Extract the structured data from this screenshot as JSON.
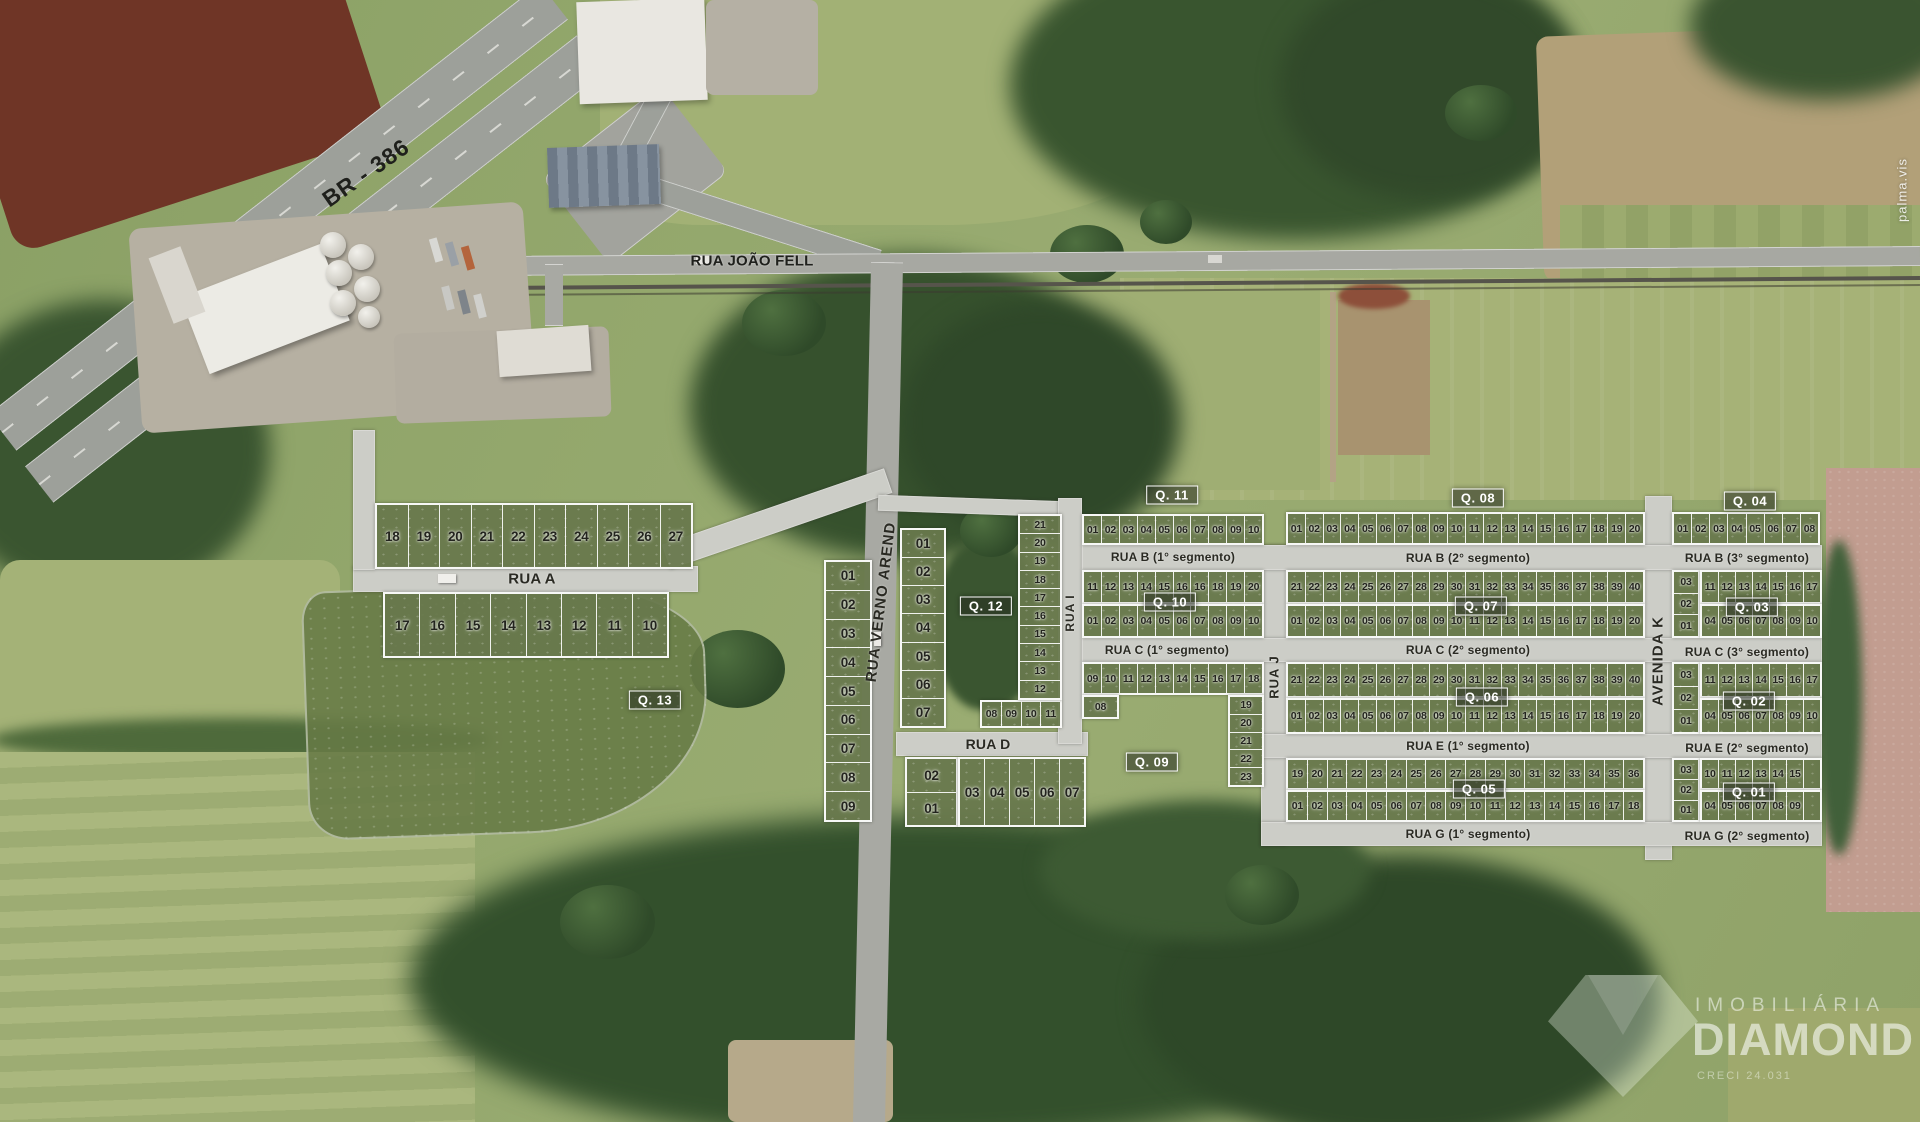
{
  "map": {
    "road_labels": {
      "br386": "BR - 386",
      "rua_joao_fell": "RUA JOÃO FELL",
      "rua_a": "RUA A",
      "rua_d": "RUA D",
      "rua_verno_arend": "RUA VERNO AREND",
      "rua_i": "RUA I",
      "rua_j": "RUA J",
      "avenida_k": "AVENIDA K",
      "rua_b_seg1": "RUA B (1° segmento)",
      "rua_b_seg2": "RUA B (2° segmento)",
      "rua_b_seg3": "RUA B (3° segmento)",
      "rua_c_seg1": "RUA C (1° segmento)",
      "rua_c_seg2": "RUA C (2° segmento)",
      "rua_c_seg3": "RUA C (3° segmento)",
      "rua_e_seg1": "RUA E (1° segmento)",
      "rua_e_seg2": "RUA E (2° segmento)",
      "rua_g_seg1": "RUA G (1° segmento)",
      "rua_g_seg2": "RUA G (2° segmento)"
    },
    "badges": [
      {
        "id": "q01",
        "label": "Q. 01",
        "x": 1749,
        "y": 792
      },
      {
        "id": "q02",
        "label": "Q. 02",
        "x": 1749,
        "y": 701
      },
      {
        "id": "q03",
        "label": "Q. 03",
        "x": 1752,
        "y": 607
      },
      {
        "id": "q04",
        "label": "Q. 04",
        "x": 1750,
        "y": 501
      },
      {
        "id": "q05",
        "label": "Q. 05",
        "x": 1479,
        "y": 789
      },
      {
        "id": "q06",
        "label": "Q. 06",
        "x": 1482,
        "y": 697
      },
      {
        "id": "q07",
        "label": "Q. 07",
        "x": 1481,
        "y": 606
      },
      {
        "id": "q08",
        "label": "Q. 08",
        "x": 1478,
        "y": 498
      },
      {
        "id": "q09",
        "label": "Q. 09",
        "x": 1152,
        "y": 762
      },
      {
        "id": "q10",
        "label": "Q. 10",
        "x": 1170,
        "y": 602
      },
      {
        "id": "q11",
        "label": "Q. 11",
        "x": 1172,
        "y": 495
      },
      {
        "id": "q12",
        "label": "Q. 12",
        "x": 986,
        "y": 606
      },
      {
        "id": "q13",
        "label": "Q. 13",
        "x": 655,
        "y": 700
      }
    ],
    "blocks": [
      {
        "name": "q13-north",
        "parts": [
          {
            "type": "row",
            "size": "lg",
            "x": 375,
            "y": 503,
            "w": 318,
            "h": 66,
            "cells": [
              "18",
              "19",
              "20",
              "21",
              "22",
              "23",
              "24",
              "25",
              "26",
              "27"
            ]
          },
          {
            "type": "row",
            "size": "lg",
            "x": 383,
            "y": 592,
            "w": 286,
            "h": 66,
            "cells": [
              "17",
              "16",
              "15",
              "14",
              "13",
              "12",
              "11",
              "10"
            ]
          }
        ]
      },
      {
        "name": "q13-west-col",
        "parts": [
          {
            "type": "col",
            "size": "lg",
            "x": 824,
            "y": 560,
            "w": 48,
            "h": 262,
            "cells": [
              "01",
              "02",
              "03",
              "04",
              "05",
              "06",
              "07",
              "08",
              "09"
            ]
          }
        ]
      },
      {
        "name": "q12",
        "parts": [
          {
            "type": "col",
            "size": "lg",
            "x": 900,
            "y": 528,
            "w": 46,
            "h": 200,
            "cells": [
              "01",
              "02",
              "03",
              "04",
              "05",
              "06",
              "07"
            ]
          },
          {
            "type": "row",
            "size": "",
            "x": 980,
            "y": 700,
            "w": 82,
            "h": 28,
            "cells": [
              "08",
              "09",
              "10",
              "11"
            ]
          },
          {
            "type": "col",
            "size": "",
            "x": 1018,
            "y": 514,
            "w": 44,
            "h": 186,
            "cells": [
              "21",
              "20",
              "19",
              "18",
              "17",
              "16",
              "15",
              "14",
              "13",
              "12"
            ]
          }
        ]
      },
      {
        "name": "q11",
        "parts": [
          {
            "type": "row",
            "size": "",
            "x": 1082,
            "y": 514,
            "w": 182,
            "h": 31,
            "cells": [
              "01",
              "02",
              "03",
              "04",
              "05",
              "06",
              "07",
              "08",
              "09",
              "10"
            ]
          }
        ]
      },
      {
        "name": "q10",
        "parts": [
          {
            "type": "row",
            "size": "",
            "x": 1082,
            "y": 570,
            "w": 182,
            "h": 34,
            "cells": [
              "11",
              "12",
              "13",
              "14",
              "15",
              "16",
              "16",
              "18",
              "19",
              "20"
            ]
          },
          {
            "type": "row",
            "size": "",
            "x": 1082,
            "y": 604,
            "w": 182,
            "h": 34,
            "cells": [
              "01",
              "02",
              "03",
              "04",
              "05",
              "06",
              "07",
              "08",
              "09",
              "10"
            ]
          }
        ]
      },
      {
        "name": "q09-west",
        "parts": [
          {
            "type": "col",
            "size": "lg",
            "x": 905,
            "y": 757,
            "w": 53,
            "h": 70,
            "cells": [
              "02",
              "01"
            ]
          },
          {
            "type": "row",
            "size": "lg",
            "x": 958,
            "y": 757,
            "w": 128,
            "h": 70,
            "cells": [
              "03",
              "04",
              "05",
              "06",
              "07"
            ]
          }
        ]
      },
      {
        "name": "q09",
        "parts": [
          {
            "type": "row",
            "size": "",
            "x": 1082,
            "y": 662,
            "w": 182,
            "h": 33,
            "cells": [
              "09",
              "10",
              "11",
              "12",
              "13",
              "14",
              "15",
              "16",
              "17",
              "18"
            ]
          },
          {
            "type": "row",
            "size": "",
            "x": 1082,
            "y": 695,
            "w": 37,
            "h": 24,
            "cells": [
              "08"
            ]
          },
          {
            "type": "col",
            "size": "",
            "x": 1228,
            "y": 695,
            "w": 36,
            "h": 92,
            "cells": [
              "19",
              "20",
              "21",
              "22",
              "23"
            ]
          }
        ]
      },
      {
        "name": "q08",
        "parts": [
          {
            "type": "row",
            "size": "",
            "x": 1286,
            "y": 512,
            "w": 359,
            "h": 33,
            "cells": [
              "01",
              "02",
              "03",
              "04",
              "05",
              "06",
              "07",
              "08",
              "09",
              "10",
              "11",
              "12",
              "13",
              "14",
              "15",
              "16",
              "17",
              "18",
              "19",
              "20"
            ]
          }
        ]
      },
      {
        "name": "q07",
        "parts": [
          {
            "type": "row",
            "size": "",
            "x": 1286,
            "y": 570,
            "w": 359,
            "h": 34,
            "cells": [
              "21",
              "22",
              "23",
              "24",
              "25",
              "26",
              "27",
              "28",
              "29",
              "30",
              "31",
              "32",
              "33",
              "34",
              "35",
              "36",
              "37",
              "38",
              "39",
              "40"
            ]
          },
          {
            "type": "row",
            "size": "",
            "x": 1286,
            "y": 604,
            "w": 359,
            "h": 34,
            "cells": [
              "01",
              "02",
              "03",
              "04",
              "05",
              "06",
              "07",
              "08",
              "09",
              "10",
              "11",
              "12",
              "13",
              "14",
              "15",
              "16",
              "17",
              "18",
              "19",
              "20"
            ]
          }
        ]
      },
      {
        "name": "q06",
        "parts": [
          {
            "type": "row",
            "size": "",
            "x": 1286,
            "y": 662,
            "w": 359,
            "h": 36,
            "cells": [
              "21",
              "22",
              "23",
              "24",
              "25",
              "26",
              "27",
              "28",
              "29",
              "30",
              "31",
              "32",
              "33",
              "34",
              "35",
              "36",
              "37",
              "38",
              "39",
              "40"
            ]
          },
          {
            "type": "row",
            "size": "",
            "x": 1286,
            "y": 698,
            "w": 359,
            "h": 36,
            "cells": [
              "01",
              "02",
              "03",
              "04",
              "05",
              "06",
              "07",
              "08",
              "09",
              "10",
              "11",
              "12",
              "13",
              "14",
              "15",
              "16",
              "17",
              "18",
              "19",
              "20"
            ]
          }
        ]
      },
      {
        "name": "q05",
        "parts": [
          {
            "type": "row",
            "size": "",
            "x": 1286,
            "y": 758,
            "w": 359,
            "h": 32,
            "cells": [
              "19",
              "20",
              "21",
              "22",
              "23",
              "24",
              "25",
              "26",
              "27",
              "28",
              "29",
              "30",
              "31",
              "32",
              "33",
              "34",
              "35",
              "36"
            ]
          },
          {
            "type": "row",
            "size": "",
            "x": 1286,
            "y": 790,
            "w": 359,
            "h": 32,
            "cells": [
              "01",
              "02",
              "03",
              "04",
              "05",
              "06",
              "07",
              "08",
              "09",
              "10",
              "11",
              "12",
              "13",
              "14",
              "15",
              "16",
              "17",
              "18"
            ]
          }
        ]
      },
      {
        "name": "q04",
        "parts": [
          {
            "type": "row",
            "size": "",
            "x": 1672,
            "y": 512,
            "w": 148,
            "h": 33,
            "cells": [
              "01",
              "02",
              "03",
              "04",
              "05",
              "06",
              "07",
              "08"
            ]
          }
        ]
      },
      {
        "name": "q03",
        "parts": [
          {
            "type": "col",
            "size": "",
            "x": 1672,
            "y": 570,
            "w": 28,
            "h": 68,
            "cells": [
              "03",
              "02",
              "01"
            ]
          },
          {
            "type": "row",
            "size": "",
            "x": 1700,
            "y": 570,
            "w": 122,
            "h": 34,
            "cells": [
              "11",
              "12",
              "13",
              "14",
              "15",
              "16",
              "17"
            ]
          },
          {
            "type": "row",
            "size": "",
            "x": 1700,
            "y": 604,
            "w": 122,
            "h": 34,
            "cells": [
              "04",
              "05",
              "06",
              "07",
              "08",
              "09",
              "10"
            ]
          }
        ]
      },
      {
        "name": "q02",
        "parts": [
          {
            "type": "col",
            "size": "",
            "x": 1672,
            "y": 662,
            "w": 28,
            "h": 72,
            "cells": [
              "03",
              "02",
              "01"
            ]
          },
          {
            "type": "row",
            "size": "",
            "x": 1700,
            "y": 662,
            "w": 122,
            "h": 36,
            "cells": [
              "11",
              "12",
              "13",
              "14",
              "15",
              "16",
              "17"
            ]
          },
          {
            "type": "row",
            "size": "",
            "x": 1700,
            "y": 698,
            "w": 122,
            "h": 36,
            "cells": [
              "04",
              "05",
              "06",
              "07",
              "08",
              "09",
              "10"
            ]
          }
        ]
      },
      {
        "name": "q01",
        "parts": [
          {
            "type": "col",
            "size": "",
            "x": 1672,
            "y": 758,
            "w": 28,
            "h": 64,
            "cells": [
              "03",
              "02",
              "01"
            ]
          },
          {
            "type": "row",
            "size": "",
            "x": 1700,
            "y": 758,
            "w": 122,
            "h": 32,
            "cells": [
              "10",
              "11",
              "12",
              "13",
              "14",
              "15",
              ""
            ]
          },
          {
            "type": "row",
            "size": "",
            "x": 1700,
            "y": 790,
            "w": 122,
            "h": 32,
            "cells": [
              "04",
              "05",
              "06",
              "07",
              "08",
              "09",
              ""
            ]
          }
        ]
      }
    ]
  },
  "watermarks": {
    "photo_credit": "palma.vis",
    "agency_top": "IMOBILIÁRIA",
    "agency_name": "DIAMOND",
    "agency_creci": "CRECI 24.031"
  },
  "colors": {
    "lot_green": "#68784d",
    "road_gray": "#cccdc7",
    "badge_background": "#262c20",
    "badge_text": "#ffffff",
    "forest_green": "#36512d",
    "label_text": "#2a2a23"
  }
}
